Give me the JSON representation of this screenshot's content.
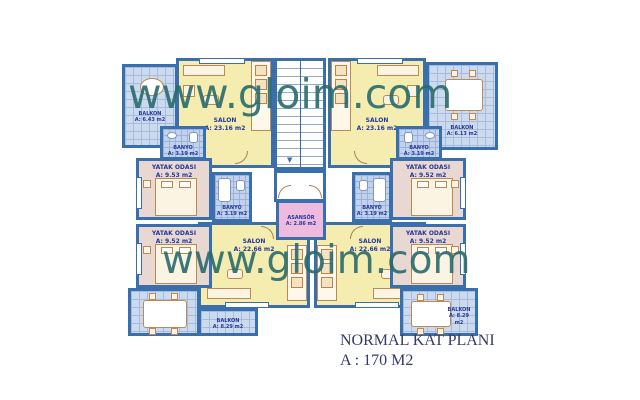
{
  "watermark": {
    "text": "www.gloim.com",
    "color": "#286a6d"
  },
  "title": {
    "line1": "NORMAL KAT PLANI",
    "line2": "A : 170 M2"
  },
  "colors": {
    "wall": "#3a6fae",
    "salon_fill": "#f5edb0",
    "bedroom_fill": "#e9d8d2",
    "balcony_tile": "#ccdaee",
    "bathroom_tile": "#c2d2ec",
    "elevator_fill": "#eebadd",
    "label_text": "#23389c",
    "title_text": "#333a6a"
  },
  "rooms": {
    "salon_tl": {
      "name": "SALON",
      "area": "A: 23.16 m2"
    },
    "salon_tr": {
      "name": "SALON",
      "area": "A: 23.16 m2"
    },
    "salon_bl": {
      "name": "SALON",
      "area": "A: 22.66 m2"
    },
    "salon_br": {
      "name": "SALON",
      "area": "A: 22.66 m2"
    },
    "yatak_tl": {
      "name": "YATAK ODASI",
      "area": "A: 9.53 m2"
    },
    "yatak_tr": {
      "name": "YATAK ODASI",
      "area": "A: 9.52 m2"
    },
    "yatak_bl": {
      "name": "YATAK ODASI",
      "area": "A: 9.52 m2"
    },
    "yatak_br": {
      "name": "YATAK ODASI",
      "area": "A: 9.52 m2"
    },
    "banyo_tl": {
      "name": "BANYO",
      "area": "A: 3.19 m2"
    },
    "banyo_tr": {
      "name": "BANYO",
      "area": "A: 3.19 m2"
    },
    "banyo_bl": {
      "name": "BANYO",
      "area": "A: 3.19 m2"
    },
    "banyo_br": {
      "name": "BANYO",
      "area": "A: 3.19 m2"
    },
    "balkon_tl": {
      "name": "BALKON",
      "area": "A: 6.43 m2"
    },
    "balkon_tr": {
      "name": "BALKON",
      "area": "A: 6.13 m2"
    },
    "balkon_bl": {
      "name": "BALKON",
      "area": "A: 8.29 m2"
    },
    "balkon_br": {
      "name": "BALKON",
      "area": "A: 8.29 m2"
    },
    "asansor": {
      "name": "ASANSÖR",
      "area": "A: 2.86 m2"
    }
  }
}
